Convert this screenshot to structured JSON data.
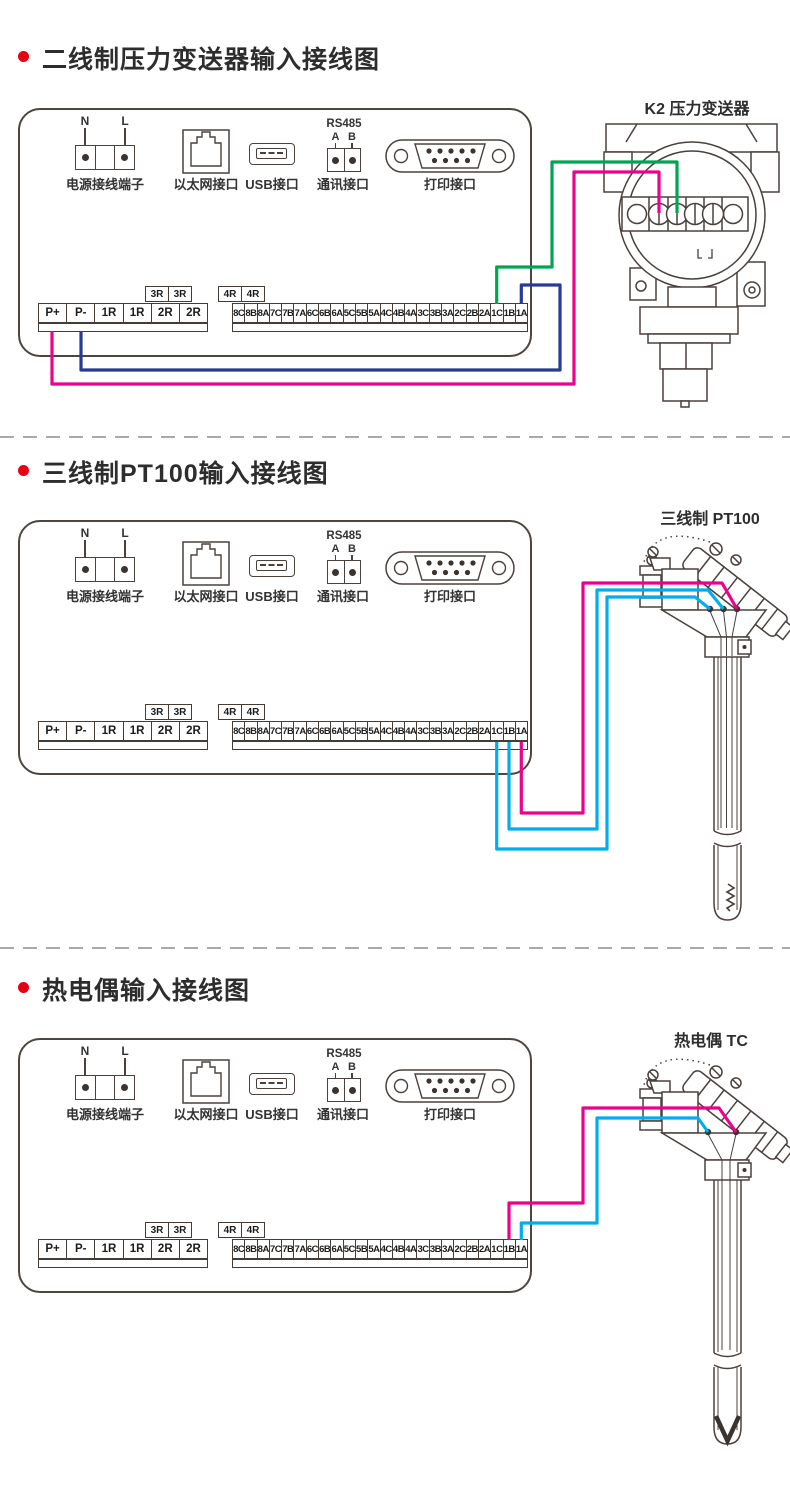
{
  "sections": [
    {
      "title": "二线制压力变送器输入接线图",
      "device_label": "K2 压力变送器"
    },
    {
      "title": "三线制PT100输入接线图",
      "device_label": "三线制 PT100"
    },
    {
      "title": "热电偶输入接线图",
      "device_label": "热电偶 TC"
    }
  ],
  "panel": {
    "power_n": "N",
    "power_l": "L",
    "power_label": "电源接线端子",
    "ethernet_label": "以太网接口",
    "usb_label": "USB接口",
    "comm_protocol": "RS485",
    "comm_a": "A",
    "comm_b": "B",
    "comm_label": "通讯接口",
    "print_label": "打印接口"
  },
  "terminal_strip": {
    "left": [
      "P+",
      "P-",
      "1R",
      "1R",
      "2R",
      "2R"
    ],
    "above_left": [
      "3R",
      "3R"
    ],
    "above_right": [
      "4R",
      "4R"
    ],
    "right": [
      "8C",
      "8B",
      "8A",
      "7C",
      "7B",
      "7A",
      "6C",
      "6B",
      "6A",
      "5C",
      "5B",
      "5A",
      "4C",
      "4B",
      "4A",
      "3C",
      "3B",
      "3A",
      "2C",
      "2B",
      "2A",
      "1C",
      "1B",
      "1A"
    ]
  },
  "transmitter": {
    "polarity": [
      "+",
      "−",
      "+",
      "−"
    ],
    "phases": [
      "A",
      "B",
      "A"
    ]
  },
  "colors": {
    "magenta": "#ec008c",
    "green": "#00a551",
    "navy": "#283a97",
    "cyan": "#00aeef",
    "line": "#4a413d",
    "bullet": "#e60012",
    "divider": "#a9a9a9"
  }
}
